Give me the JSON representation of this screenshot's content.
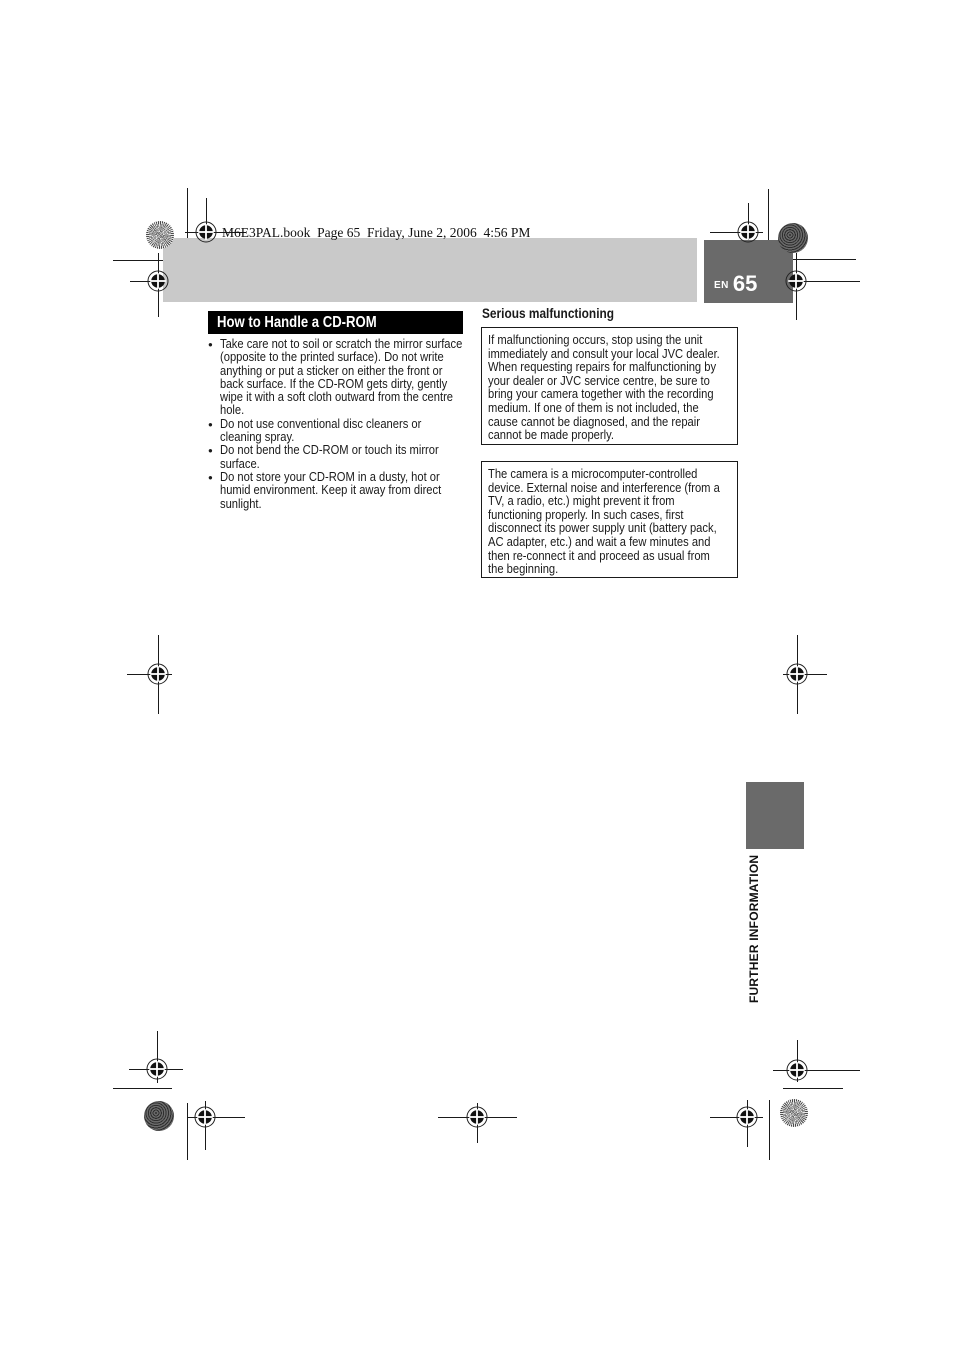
{
  "page": {
    "header_line": "M6E3PAL.book  Page 65  Friday, June 2, 2006  4:56 PM",
    "page_number_prefix": "EN",
    "page_number": "65",
    "sidebar_label": "FURTHER INFORMATION"
  },
  "left_column": {
    "title": "How to Handle a CD-ROM",
    "bullet_char": "●",
    "bullets": [
      "Take care not to soil or scratch the mirror surface\n(opposite to the printed surface). Do not write\nanything or put a sticker on either the front or\nback surface. If the CD-ROM gets dirty, gently\nwipe it with a soft cloth outward from the centre\nhole.",
      "Do not use conventional disc cleaners or\ncleaning spray.",
      "Do not bend the CD-ROM or touch its mirror\nsurface.",
      "Do not store your CD-ROM in a dusty, hot or\nhumid environment. Keep it away from direct\nsunlight."
    ]
  },
  "right_column": {
    "heading": "Serious malfunctioning",
    "box1": "If malfunctioning occurs, stop using the unit\nimmediately and consult your local JVC dealer.\nWhen requesting repairs for malfunctioning by\nyour dealer or JVC service centre, be sure to\nbring your camera together with the recording\nmedium. If one of them is not included, the\ncause cannot be diagnosed, and the repair\ncannot be made properly.",
    "box2": "The camera is a microcomputer-controlled\ndevice. External noise and interference (from a\nTV, a radio, etc.) might prevent it from\nfunctioning properly. In such cases, first\ndisconnect its power supply unit (battery pack,\nAC adapter, etc.) and wait a few minutes and\nthen re-connect it and proceed as usual from\nthe beginning."
  },
  "colors": {
    "band_gray": "#c9c9c9",
    "badge_gray": "#6a6a6a",
    "title_bar_black": "#000000",
    "text_black": "#1a1a1a"
  },
  "marks": {
    "registration": "crosshair-target-mark",
    "pinwheel": "radial-starburst-mark",
    "halftone": "speckled-dot-mark"
  }
}
